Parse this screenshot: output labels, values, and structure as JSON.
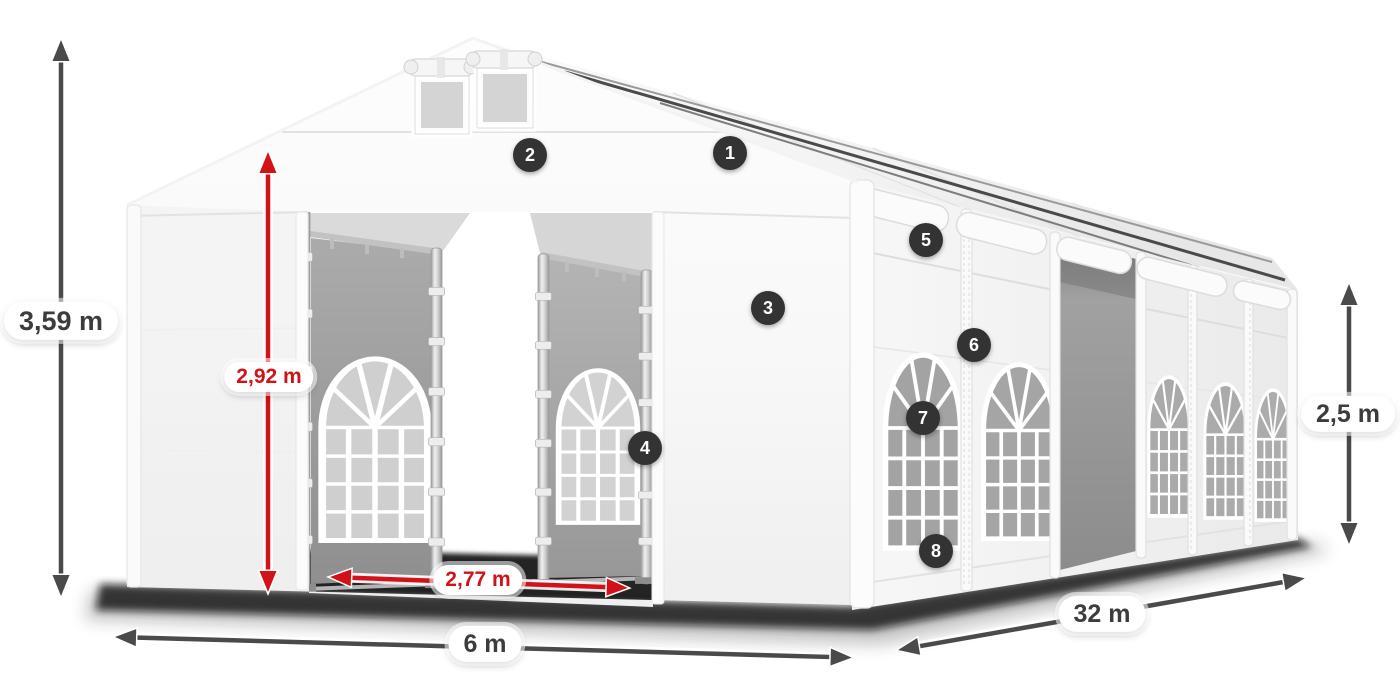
{
  "diagram": {
    "background_color": "#ffffff",
    "subject": "White marquee tent shown in perspective with dimension arrows and numbered feature markers"
  },
  "colors": {
    "dimension_arrow_gray": "#4a4a4a",
    "dimension_arrow_red": "#d21118",
    "label_pill_background": "#ffffff",
    "label_text_gray": "#3c3c3c",
    "label_text_red": "#d21118",
    "marker_background": "#333333",
    "marker_text": "#ffffff"
  },
  "dimension_labels": [
    {
      "id": "total_height",
      "label": "3,59 m",
      "style": "gray"
    },
    {
      "id": "entrance_height",
      "label": "2,92 m",
      "style": "red"
    },
    {
      "id": "entrance_width",
      "label": "2,77 m",
      "style": "red"
    },
    {
      "id": "gable_width",
      "label": "6 m",
      "style": "gray"
    },
    {
      "id": "length",
      "label": "32 m",
      "style": "gray"
    },
    {
      "id": "side_wall_height",
      "label": "2,5 m",
      "style": "gray"
    }
  ],
  "feature_markers": [
    {
      "number": "1"
    },
    {
      "number": "2"
    },
    {
      "number": "3"
    },
    {
      "number": "4"
    },
    {
      "number": "5"
    },
    {
      "number": "6"
    },
    {
      "number": "7"
    },
    {
      "number": "8"
    }
  ]
}
